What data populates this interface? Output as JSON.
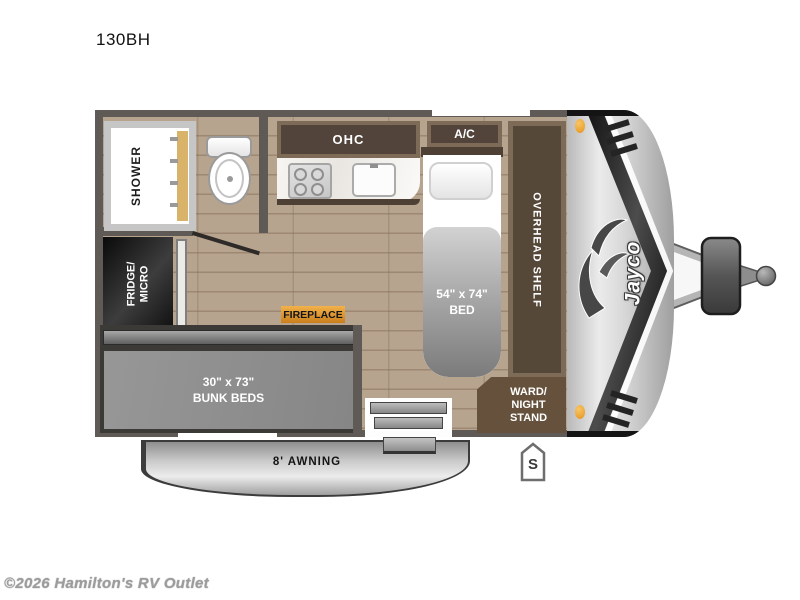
{
  "title": "130BH",
  "watermark": "©2026 Hamilton's RV Outlet",
  "brand": "Jayco",
  "floorplan": {
    "labels": {
      "shower": "SHOWER",
      "ohc": "OHC",
      "ac": "A/C",
      "fridge_line1": "FRIDGE/",
      "fridge_line2": "MICRO",
      "fireplace": "FIREPLACE",
      "bed_line1": "54\" x 74\"",
      "bed_line2": "BED",
      "overhead_shelf": "OVERHEAD SHELF",
      "ward_line1": "WARD/",
      "ward_line2": "NIGHT",
      "ward_line3": "STAND",
      "bunk_line1": "30\" x 73\"",
      "bunk_line2": "BUNK BEDS",
      "awning": "8' AWNING",
      "door_marker": "S"
    },
    "colors": {
      "wall": "#5f5a55",
      "floor_wood": "#b7a48e",
      "cabinet_brown": "#52443a",
      "fireplace_amber": "#eda43b",
      "marker_light_orange": "#e5941d",
      "bunk_gray": "#8f8f8f"
    }
  }
}
